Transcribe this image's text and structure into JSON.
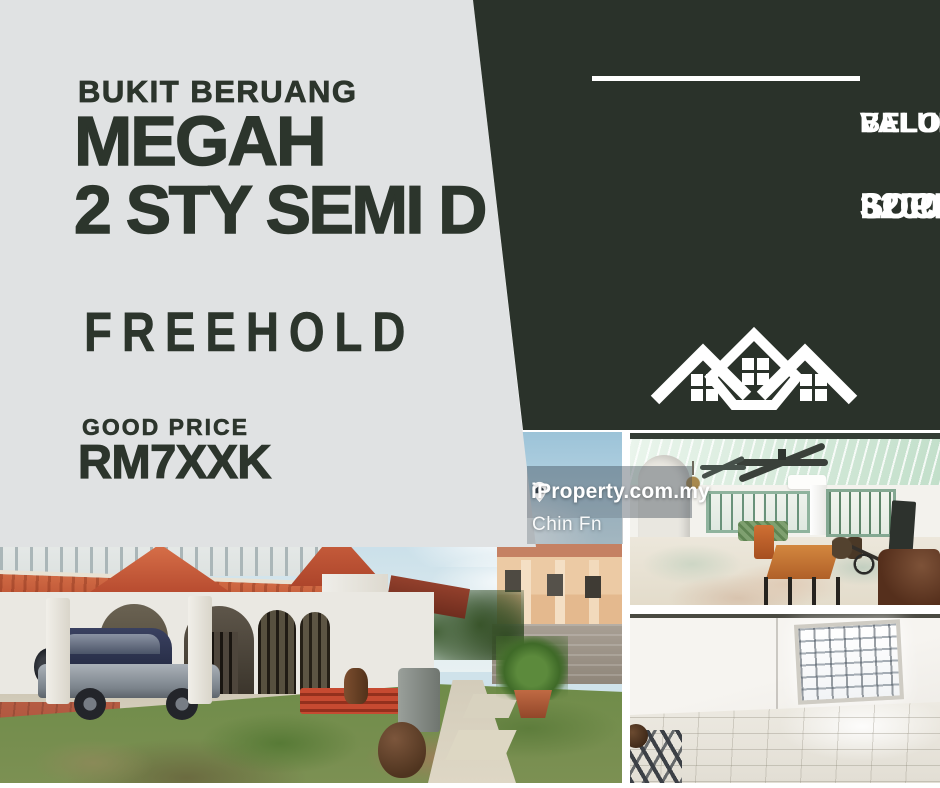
{
  "poster": {
    "left_block": {
      "location": "BUKIT BERUANG",
      "project": "MEGAH",
      "property_type": "2 STY SEMI D",
      "tenure": "FREEHOLD",
      "price_label": "GOOD PRICE",
      "price": "RM7XXK"
    },
    "right_panel": {
      "banner_line1": "BELOW BANK",
      "banner_line2": "VALUE 8%",
      "feature_line1": "3200 SQ.FT",
      "feature_line2": "SUPER ÑICE",
      "feature_line3": "LOCATION"
    },
    "watermark": {
      "brand": "iProperty.com.my",
      "agent": "Chin Fn"
    },
    "photos": [
      {
        "name": "exterior-photo",
        "description": "2 storey semi-detached house exterior with arched carport, SUV and garden"
      },
      {
        "name": "interior-hall-photo",
        "description": "living hall with ceiling fans, green-framed windows, marble floor and wooden table"
      },
      {
        "name": "empty-room-photo",
        "description": "empty room with barred window and glossy tiled floor"
      }
    ],
    "icons": {
      "houses_roofline": "houses-roofline-icon",
      "map_pin_house": "map-pin-house-icon"
    },
    "colors": {
      "dark_green": "#2a322a",
      "light_gray": "#e0e2e3",
      "white": "#ffffff"
    }
  }
}
